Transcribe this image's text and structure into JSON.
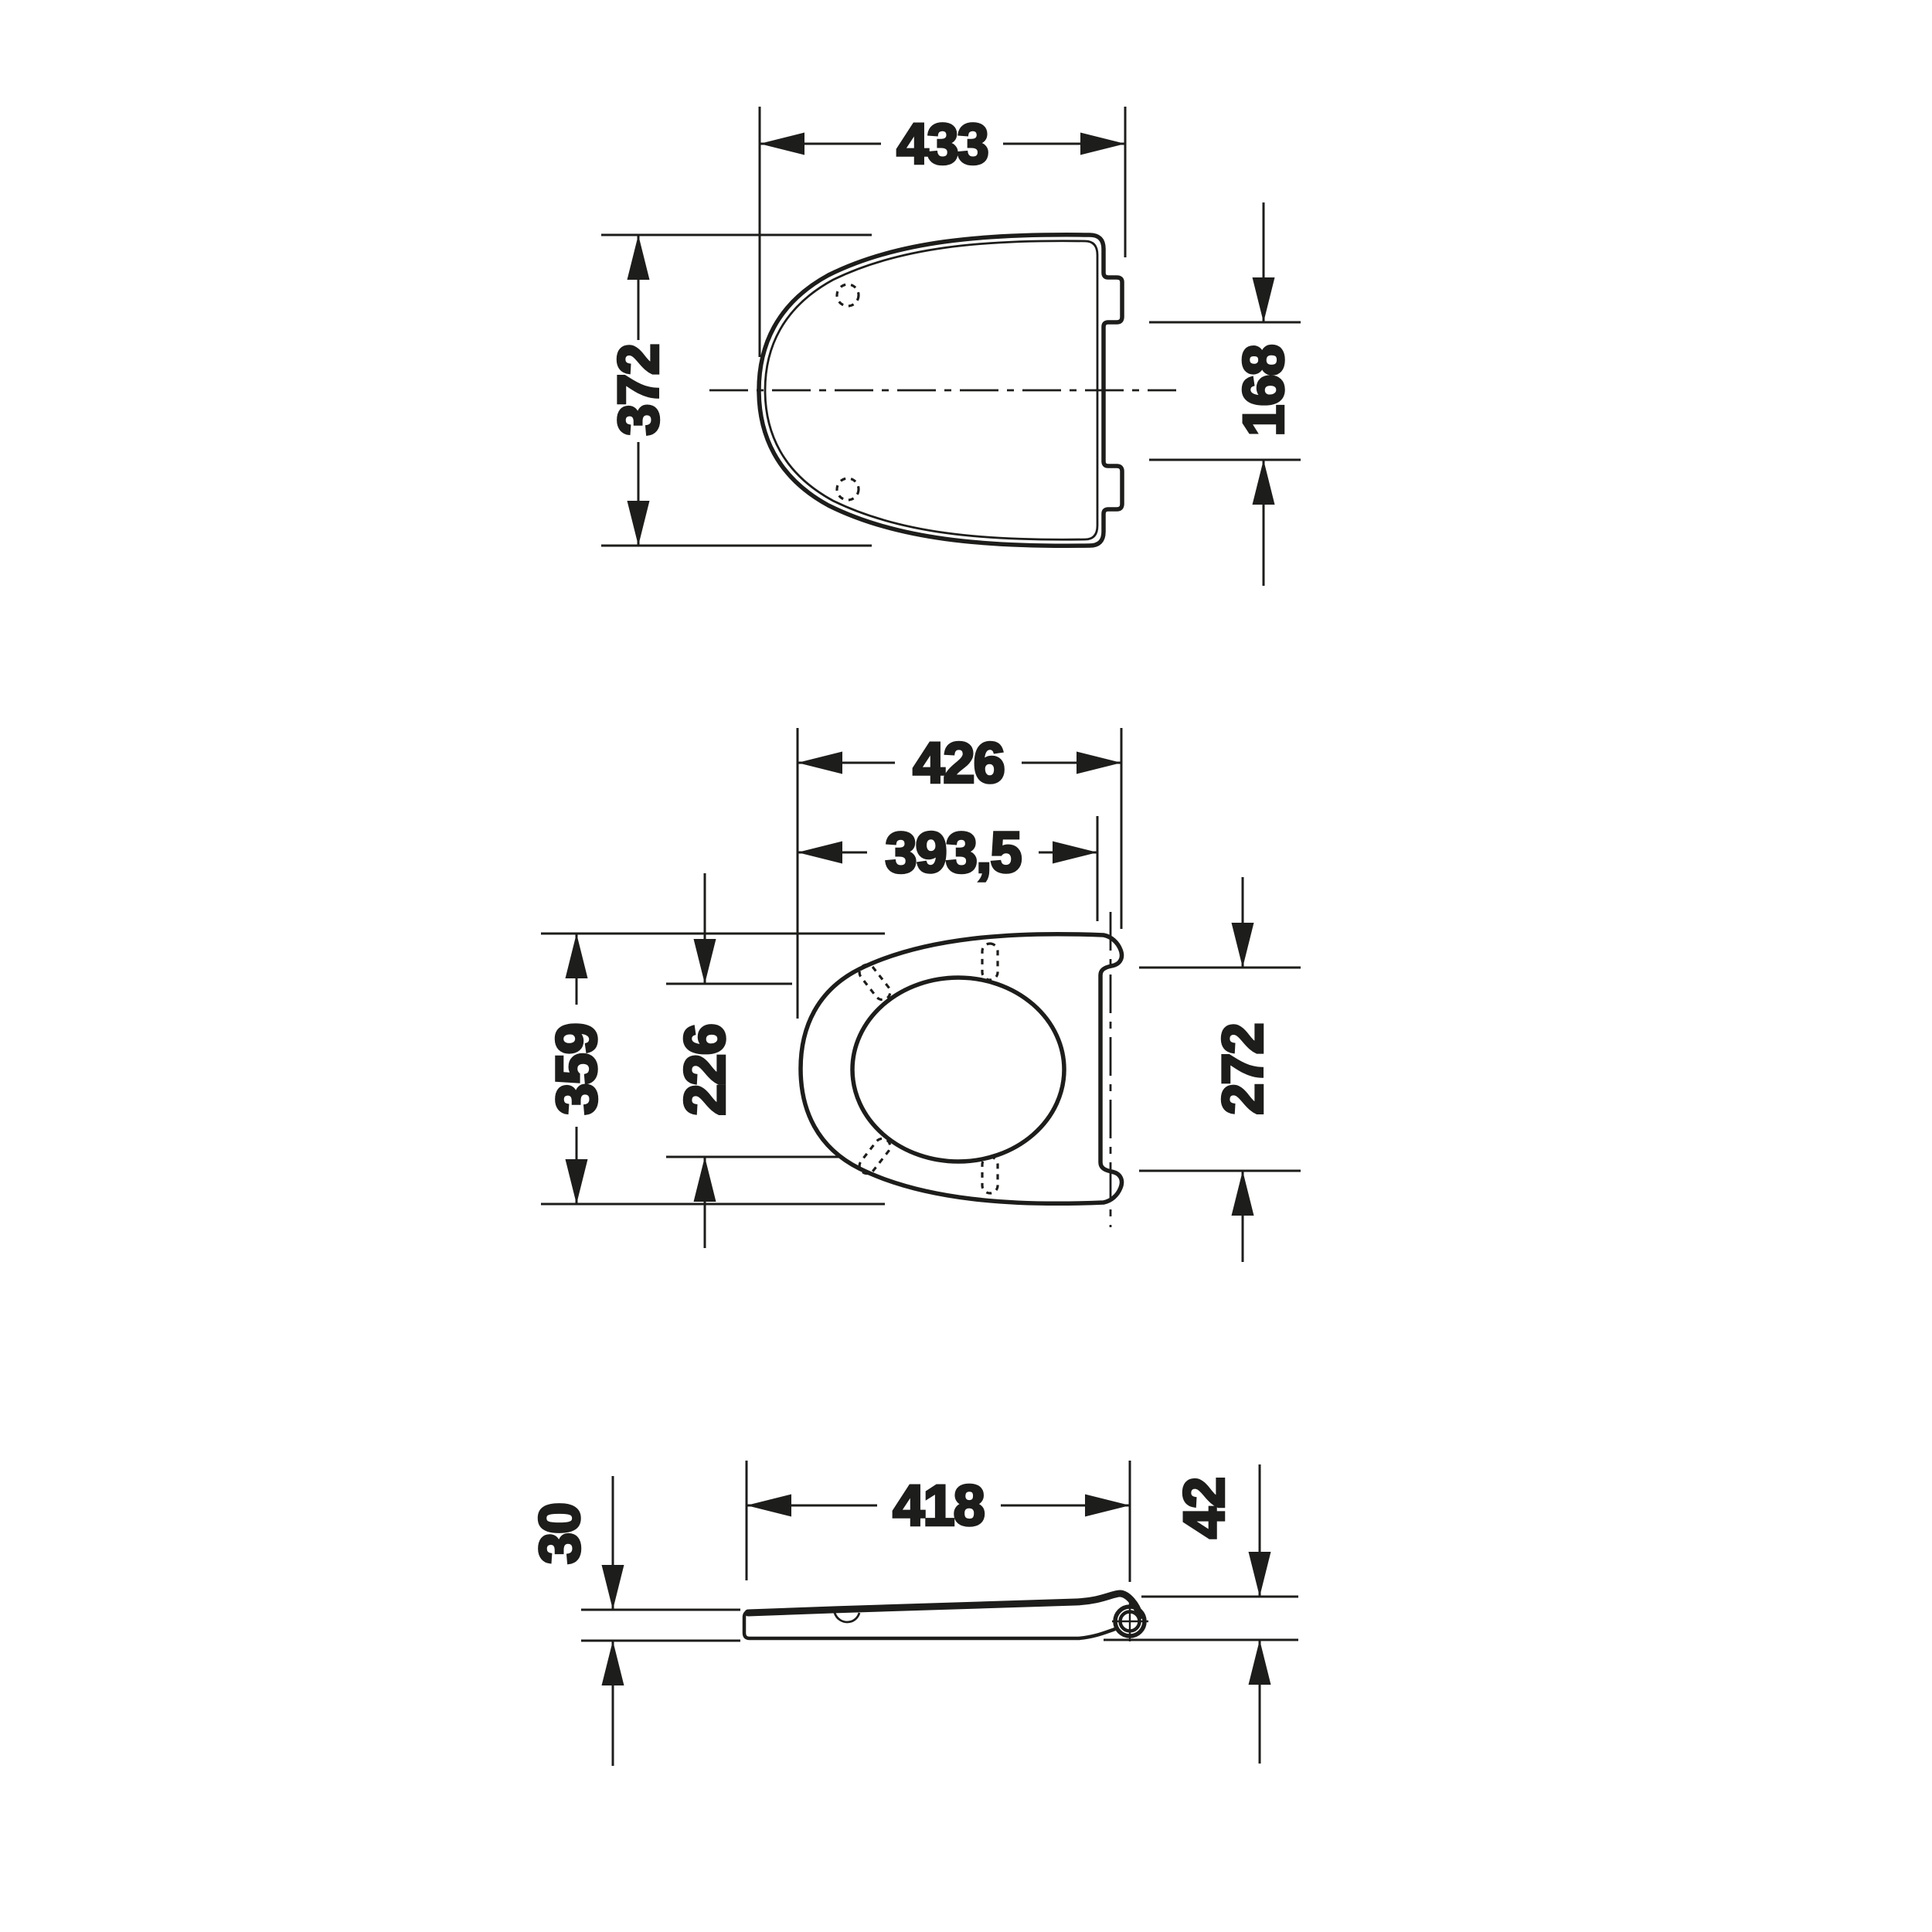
{
  "canvas": {
    "background": "#ffffff",
    "ink": "#1d1d1b"
  },
  "views": {
    "lid_top": {
      "title": "lid-top-view",
      "dims": {
        "width": "433",
        "depth": "372",
        "hinge_notch_span": "168"
      }
    },
    "ring_top": {
      "title": "seat-ring-top-view",
      "dims": {
        "overall_width": "426",
        "width_to_hinge_axis": "393,5",
        "outer_depth": "359",
        "bumper_spacing": "226",
        "hinge_side_depth": "272"
      }
    },
    "profile_side": {
      "title": "seat-profile-side-view",
      "dims": {
        "length": "418",
        "front_thickness": "30",
        "hinge_height": "42"
      }
    }
  }
}
